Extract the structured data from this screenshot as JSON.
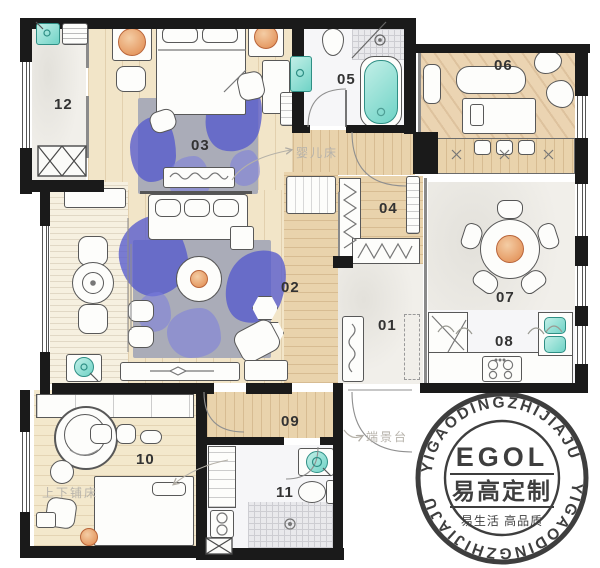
{
  "plan": {
    "rooms": [
      {
        "id": "room-01",
        "label": "01"
      },
      {
        "id": "room-02",
        "label": "02"
      },
      {
        "id": "room-03",
        "label": "03"
      },
      {
        "id": "room-04",
        "label": "04"
      },
      {
        "id": "room-05",
        "label": "05"
      },
      {
        "id": "room-06",
        "label": "06"
      },
      {
        "id": "room-07",
        "label": "07"
      },
      {
        "id": "room-08",
        "label": "08"
      },
      {
        "id": "room-09",
        "label": "09"
      },
      {
        "id": "room-10",
        "label": "10"
      },
      {
        "id": "room-11",
        "label": "11"
      },
      {
        "id": "room-12",
        "label": "12"
      }
    ],
    "annotations": {
      "baby_crib": "婴儿床",
      "end_view_stand": "端景台",
      "bunk_bed": "上下铺床"
    },
    "stamp": {
      "logo": "EGOL",
      "brand_cn": "易高定制",
      "slogan_cn": "易生活 高品质",
      "ring_text": "YIGAODINGZHIJIAJU"
    },
    "colors": {
      "wall": "#1a1a1a",
      "wood_floor": "#f2e5c8",
      "hall_wood": "#e9d3ac",
      "rug_gray": "#aaacb8",
      "paint_splash_blue": "#5d62c6",
      "fixture_teal": "#7fd8cc",
      "accent_orange": "#e89a5e",
      "stamp_ink": "#1d1d1d",
      "annotation_gray": "#b7b3ab"
    }
  }
}
